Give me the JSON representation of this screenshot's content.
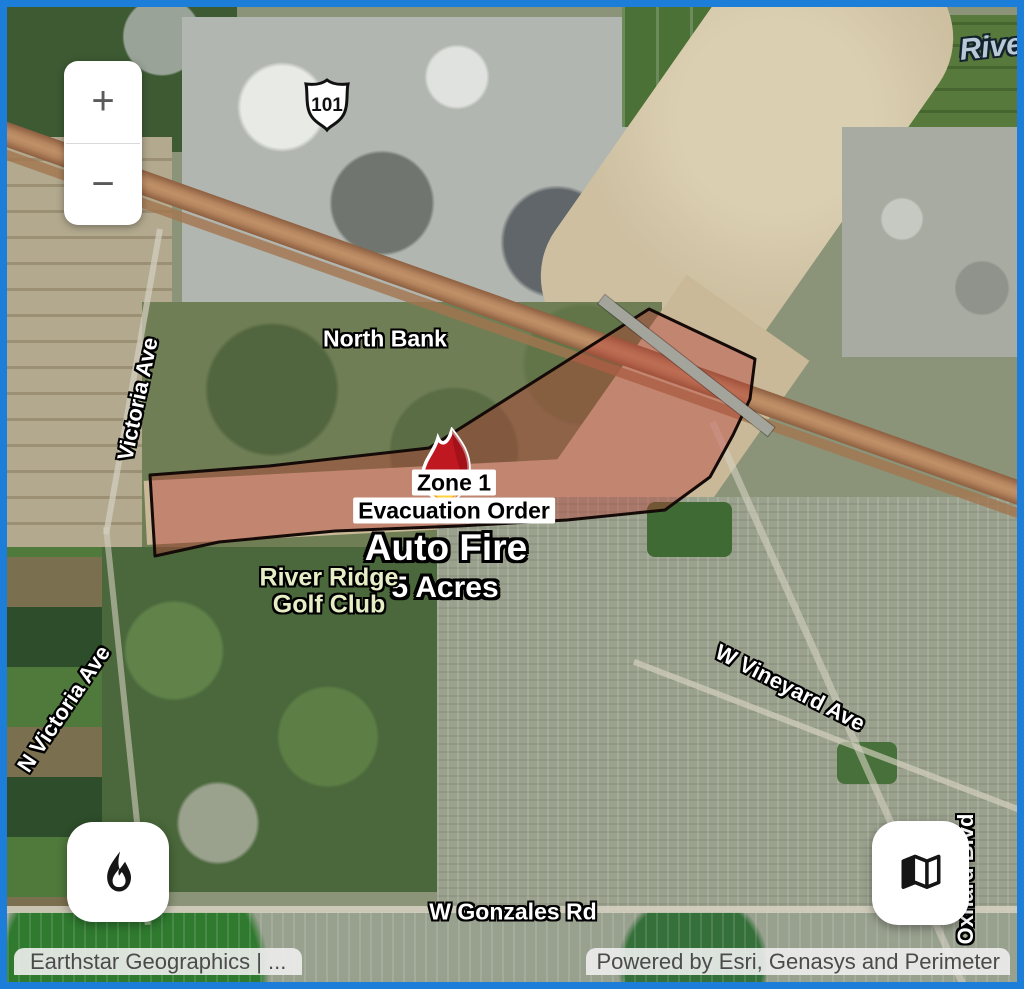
{
  "window": {
    "frame_color": "#1d7ed9"
  },
  "zoom_control": {
    "zoom_in_label": "+",
    "zoom_out_label": "−"
  },
  "icons": {
    "zoom_in": "plus-icon",
    "zoom_out": "minus-icon",
    "fire_button": "flame-icon",
    "basemap_button": "map-icon"
  },
  "map_labels": {
    "highway_shield": "101",
    "north_bank": "North Bank",
    "river": "River",
    "victoria_ave": "Victoria Ave",
    "n_victoria_ave": "N Victoria Ave",
    "w_vineyard_ave": "W Vineyard Ave",
    "w_gonzales_rd": "W Gonzales Rd",
    "oxnard_blvd": "Oxnard Blvd",
    "golf_club_line1": "River Ridge",
    "golf_club_line2": "Golf Club"
  },
  "incident": {
    "zone_label": "Zone 1",
    "order_label": "Evacuation Order",
    "fire_name": "Auto Fire",
    "fire_size": "5 Acres"
  },
  "evacuation_zone": {
    "polygon_points": "143,468 262,459 422,441 642,302 748,352 743,392 726,428 703,470 658,503 560,513 452,519 328,524 212,535 148,549",
    "fill": "rgba(186,62,55,0.42)",
    "stroke": "#140a08",
    "stroke_width": "3"
  },
  "attribution": {
    "basemap_credit": "Earthstar Geographics | ...",
    "powered_by": "Powered by Esri, Genasys and Perimeter"
  }
}
